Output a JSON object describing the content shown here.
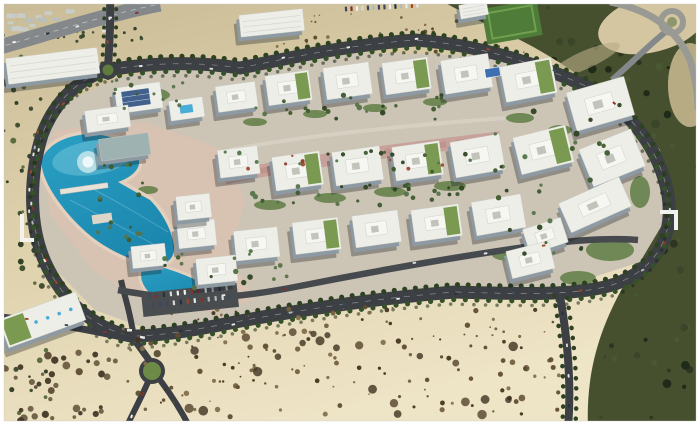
{
  "meta": {
    "kind": "architectural aerial rendering",
    "subject": "master-planned office campus in desert with lagoon, ring road and landscaping",
    "visible_text": "none"
  },
  "colors": {
    "frame": "#ffffff",
    "sandTop": "#c9bb96",
    "sandMid": "#dccfa9",
    "sandLow": "#eee4c6",
    "road": "#3c3f43",
    "roadLight": "#84888b",
    "roadInner": "#46494d",
    "hill": "#46502f",
    "hillDark": "#2d3620",
    "plate": "#ccc4b5",
    "plaza": "#d8c2b1",
    "boulevard": "#c7a29a",
    "water": "#2aa0c4",
    "waterDeep": "#1c87ae",
    "waterLight": "#6fc2d8",
    "beach": "#e3d0bd",
    "treeDark": "#2e4122",
    "treeMid": "#45602f",
    "buildingTop": "#edeee8",
    "buildingSide": "#8d9aa3",
    "glassTop": "#9fb2b2",
    "shadow": "rgba(25,30,35,0.33)",
    "roofGreen": "#7a9a52",
    "solar": "#41608c",
    "pool": "#48acd6",
    "court": "#3e6fb0",
    "grassField": "#4f7c38",
    "greenPatch": "#66824a",
    "carPalette": [
      "#f2f2f2",
      "#d9d9d9",
      "#3a4a5c",
      "#8c2f2a",
      "#b3b8bc",
      "#27313a",
      "#a34428",
      "#e8e8e8"
    ]
  },
  "buildings": [
    [
      138,
      100,
      46,
      26,
      -8,
      "solar"
    ],
    [
      186,
      111,
      34,
      20,
      -8,
      "pool"
    ],
    [
      236,
      99,
      40,
      26,
      -8,
      "plain"
    ],
    [
      288,
      90,
      44,
      30,
      -8,
      "green"
    ],
    [
      347,
      83,
      46,
      32,
      -8,
      "plain"
    ],
    [
      406,
      78,
      46,
      32,
      -8,
      "green"
    ],
    [
      466,
      76,
      48,
      34,
      -9,
      "plain"
    ],
    [
      528,
      82,
      52,
      36,
      -11,
      "green"
    ],
    [
      600,
      106,
      60,
      40,
      -16,
      "plain"
    ],
    [
      238,
      164,
      40,
      28,
      -7,
      "plain"
    ],
    [
      297,
      173,
      48,
      34,
      -8,
      "green"
    ],
    [
      357,
      168,
      48,
      34,
      -8,
      "plain"
    ],
    [
      417,
      163,
      48,
      34,
      -8,
      "green"
    ],
    [
      477,
      158,
      50,
      36,
      -10,
      "plain"
    ],
    [
      543,
      152,
      54,
      38,
      -14,
      "green"
    ],
    [
      612,
      160,
      56,
      40,
      -22,
      "plain"
    ],
    [
      595,
      207,
      66,
      32,
      -24,
      "plain"
    ],
    [
      196,
      236,
      38,
      26,
      -6,
      "plain"
    ],
    [
      256,
      246,
      44,
      30,
      -6,
      "plain"
    ],
    [
      316,
      238,
      46,
      32,
      -7,
      "green"
    ],
    [
      376,
      231,
      46,
      32,
      -8,
      "plain"
    ],
    [
      436,
      225,
      48,
      32,
      -8,
      "green"
    ],
    [
      498,
      217,
      50,
      34,
      -10,
      "plain"
    ],
    [
      545,
      238,
      40,
      26,
      -18,
      "plain"
    ],
    [
      530,
      262,
      44,
      28,
      -14,
      "plain"
    ],
    [
      107,
      121,
      44,
      22,
      -8,
      "plain"
    ],
    [
      124,
      149,
      50,
      22,
      -8,
      "glass"
    ],
    [
      193,
      209,
      34,
      24,
      -6,
      "plain"
    ],
    [
      148,
      258,
      34,
      22,
      -6,
      "plain"
    ],
    [
      216,
      272,
      40,
      26,
      -6,
      "plain"
    ],
    [
      42,
      322,
      82,
      30,
      -20,
      "sky"
    ],
    [
      52,
      68,
      92,
      26,
      -7,
      "shed"
    ],
    [
      271,
      25,
      64,
      22,
      -6,
      "shed"
    ],
    [
      473,
      12,
      28,
      14,
      -10,
      "shed"
    ]
  ],
  "green_patches": [
    [
      270,
      205,
      16,
      5
    ],
    [
      330,
      198,
      16,
      5
    ],
    [
      390,
      192,
      16,
      5
    ],
    [
      450,
      186,
      16,
      5
    ],
    [
      255,
      122,
      12,
      4
    ],
    [
      315,
      114,
      12,
      4
    ],
    [
      375,
      108,
      12,
      4
    ],
    [
      435,
      102,
      12,
      4
    ],
    [
      520,
      118,
      14,
      5
    ],
    [
      510,
      255,
      18,
      6
    ],
    [
      560,
      130,
      12,
      5
    ],
    [
      148,
      190,
      10,
      4
    ],
    [
      610,
      250,
      24,
      11
    ],
    [
      578,
      278,
      18,
      7
    ],
    [
      640,
      192,
      10,
      16
    ],
    [
      150,
      95,
      20,
      7
    ]
  ],
  "scatter": [
    {
      "layer": "city-blocks",
      "shape": "rect",
      "box": [
        2,
        8,
        140,
        26
      ],
      "n": 24,
      "rmin": 2,
      "rmax": 5,
      "seed": 11,
      "colors": [
        "#c9cdc9",
        "#b9bfb9",
        "#dfe2df"
      ]
    },
    {
      "layer": "city-trees",
      "box": [
        0,
        28,
        152,
        16
      ],
      "n": 22,
      "rmin": 1,
      "rmax": 2,
      "seed": 12,
      "colors": [
        "#2e3c26",
        "#3c4c30"
      ]
    },
    {
      "layer": "hill-texture",
      "box": [
        440,
        0,
        260,
        428
      ],
      "n": 170,
      "rmin": 1.5,
      "rmax": 4.5,
      "seed": 21,
      "colors": [
        "#2c3520",
        "#3a452a",
        "#1f2817",
        "#4a5733"
      ]
    },
    {
      "layer": "sand-top",
      "box": [
        250,
        8,
        280,
        80
      ],
      "n": 70,
      "rmin": 0.7,
      "rmax": 2,
      "seed": 31,
      "colors": [
        "#6e5c3e",
        "#59482c",
        "#7e6c48"
      ]
    },
    {
      "layer": "desert-bottom",
      "box": [
        118,
        305,
        445,
        112
      ],
      "n": 150,
      "rmin": 0.8,
      "rmax": 2.8,
      "seed": 41,
      "colors": [
        "#5f4c33",
        "#74603f",
        "#46351f",
        "#83704c"
      ]
    },
    {
      "layer": "desert-bottom",
      "box": [
        150,
        330,
        380,
        85
      ],
      "n": 26,
      "rmin": 3,
      "rmax": 5,
      "seed": 42,
      "opacity": 0.8,
      "colors": [
        "#54422a",
        "#3f3220"
      ]
    },
    {
      "layer": "left-trees",
      "box": [
        0,
        55,
        46,
        370
      ],
      "n": 46,
      "rmin": 1.2,
      "rmax": 3,
      "seed": 51,
      "colors": [
        "#3a4a2b",
        "#2c3a20",
        "#57683a"
      ]
    },
    {
      "layer": "rocks-sw",
      "box": [
        0,
        352,
        118,
        70
      ],
      "n": 40,
      "rmin": 1.5,
      "rmax": 4,
      "seed": 61,
      "colors": [
        "#5d4a33",
        "#433726",
        "#6e5d42"
      ]
    },
    {
      "layer": "campus-trees",
      "box": [
        235,
        95,
        210,
        25
      ],
      "n": 24,
      "rmin": 1.4,
      "rmax": 2.8,
      "seed": 71,
      "colors": [
        "#3f5a2e",
        "#55744a",
        "#2f4522"
      ]
    },
    {
      "layer": "campus-trees",
      "box": [
        230,
        185,
        240,
        22
      ],
      "n": 28,
      "rmin": 1.4,
      "rmax": 2.8,
      "seed": 72,
      "colors": [
        "#3f5a2e",
        "#55744a",
        "#2f4522"
      ]
    },
    {
      "layer": "campus-trees",
      "box": [
        160,
        250,
        130,
        42
      ],
      "n": 18,
      "rmin": 1.4,
      "rmax": 2.8,
      "seed": 73,
      "colors": [
        "#3f5a2e",
        "#55744a",
        "#2f4522"
      ]
    },
    {
      "layer": "campus-trees",
      "box": [
        490,
        105,
        130,
        150
      ],
      "n": 26,
      "rmin": 1.5,
      "rmax": 3,
      "seed": 74,
      "colors": [
        "#3f5a2e",
        "#2f4522",
        "#55744a"
      ]
    },
    {
      "layer": "campus-trees",
      "box": [
        88,
        158,
        62,
        92
      ],
      "n": 16,
      "rmin": 1.3,
      "rmax": 2.6,
      "seed": 75,
      "colors": [
        "#3f5a2e",
        "#55744a"
      ]
    },
    {
      "layer": "campus-trees",
      "box": [
        112,
        80,
        72,
        30
      ],
      "n": 12,
      "rmin": 1.3,
      "rmax": 2.6,
      "seed": 76,
      "colors": [
        "#3f5a2e",
        "#55744a"
      ]
    },
    {
      "layer": "boulevard-trees",
      "box": [
        225,
        150,
        280,
        22
      ],
      "n": 22,
      "rmin": 1.3,
      "rmax": 2.4,
      "seed": 81,
      "colors": [
        "#3f5a2e",
        "#55744a",
        "#2f4522"
      ]
    },
    {
      "layer": "boulevard-trees",
      "box": [
        240,
        150,
        235,
        20
      ],
      "n": 8,
      "rmin": 1.2,
      "rmax": 2.2,
      "seed": 82,
      "colors": [
        "#8a3b2c",
        "#a04a30"
      ]
    }
  ],
  "car_strips": [
    {
      "pts": [
        [
          108,
          70
        ],
        [
          160,
          64
        ],
        [
          233,
          70
        ],
        [
          300,
          55
        ],
        [
          360,
          45
        ],
        [
          420,
          40
        ],
        [
          480,
          48
        ],
        [
          540,
          65
        ],
        [
          600,
          92
        ],
        [
          640,
          128
        ]
      ],
      "n": 8,
      "seed": 101
    },
    {
      "pts": [
        [
          660,
          160
        ],
        [
          670,
          200
        ],
        [
          668,
          235
        ],
        [
          650,
          265
        ],
        [
          612,
          284
        ],
        [
          560,
          294
        ]
      ],
      "n": 6,
      "seed": 102
    },
    {
      "pts": [
        [
          540,
          294
        ],
        [
          470,
          291
        ],
        [
          400,
          297
        ],
        [
          330,
          306
        ],
        [
          260,
          320
        ],
        [
          200,
          330
        ],
        [
          150,
          336
        ]
      ],
      "n": 7,
      "seed": 103
    },
    {
      "pts": [
        [
          100,
          324
        ],
        [
          70,
          300
        ],
        [
          48,
          265
        ],
        [
          33,
          225
        ],
        [
          30,
          180
        ],
        [
          40,
          138
        ],
        [
          60,
          105
        ],
        [
          85,
          82
        ]
      ],
      "n": 5,
      "seed": 104
    },
    {
      "pts": [
        [
          562,
          300
        ],
        [
          566,
          340
        ],
        [
          570,
          380
        ],
        [
          568,
          420
        ]
      ],
      "n": 4,
      "seed": 105
    },
    {
      "pts": [
        [
          125,
          292
        ],
        [
          200,
          300
        ],
        [
          300,
          286
        ],
        [
          400,
          264
        ],
        [
          500,
          250
        ],
        [
          580,
          241
        ]
      ],
      "n": 7,
      "seed": 106
    },
    {
      "pts": [
        [
          0,
          44
        ],
        [
          60,
          30
        ],
        [
          120,
          16
        ],
        [
          155,
          8
        ]
      ],
      "n": 5,
      "seed": 107
    },
    {
      "pts": [
        [
          10,
          318
        ],
        [
          70,
          326
        ],
        [
          120,
          334
        ]
      ],
      "n": 3,
      "seed": 108
    },
    {
      "pts": [
        [
          147,
          385
        ],
        [
          133,
          408
        ],
        [
          127,
          425
        ]
      ],
      "n": 2,
      "seed": 109
    },
    {
      "pts": [
        [
          109,
          10
        ],
        [
          108,
          50
        ]
      ],
      "n": 2,
      "seed": 110
    },
    {
      "pts": [
        [
          38,
          128
        ],
        [
          30,
          170
        ],
        [
          30,
          215
        ],
        [
          40,
          255
        ],
        [
          58,
          285
        ]
      ],
      "n": 14,
      "seed": 111
    }
  ],
  "parking_rows": [
    {
      "x": 150,
      "y": 296,
      "angle": -6,
      "n": 12,
      "gap": 7,
      "seed": 121
    },
    {
      "x": 153,
      "y": 305,
      "angle": -6,
      "n": 12,
      "gap": 7,
      "seed": 122
    },
    {
      "x": 346,
      "y": 9,
      "angle": -3,
      "n": 14,
      "gap": 5.5,
      "seed": 123
    }
  ]
}
